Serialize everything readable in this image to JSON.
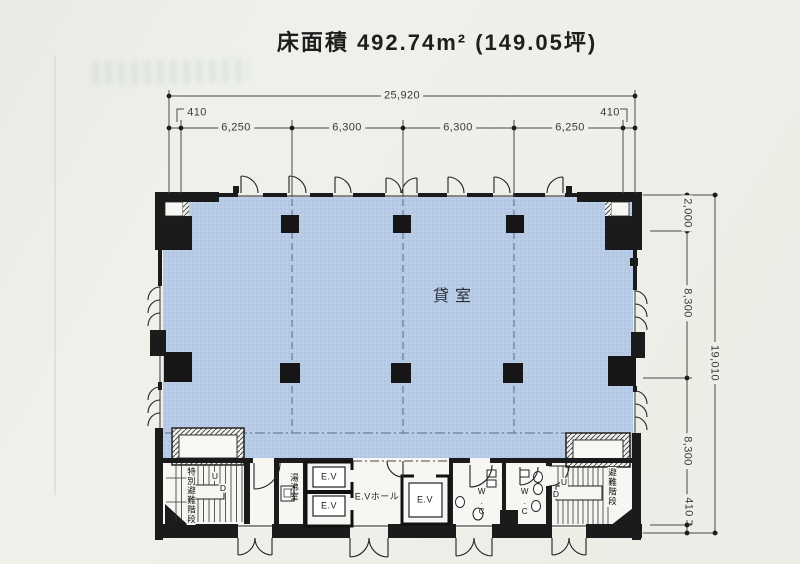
{
  "title": "床面積 492.74m² (149.05坪)",
  "dims": {
    "w_total": "25,920",
    "w": [
      "410",
      "6,250",
      "6,300",
      "6,300",
      "6,250",
      "410"
    ],
    "h_total": "19,010",
    "h": [
      "2,000",
      "8,300",
      "8,300",
      "410"
    ]
  },
  "rooms": {
    "main": "貸室",
    "stair_special": "特別避難階段",
    "stair": "避難階段",
    "kitchen": "湯沸室",
    "ev": "E.V",
    "ev_hall": "E.Vホール",
    "wc": "W.C",
    "up": "U",
    "down": "D"
  },
  "colors": {
    "tenant_fill": "#b7cbe6",
    "wall": "#1b1b1b",
    "paper": "#edefe9"
  }
}
